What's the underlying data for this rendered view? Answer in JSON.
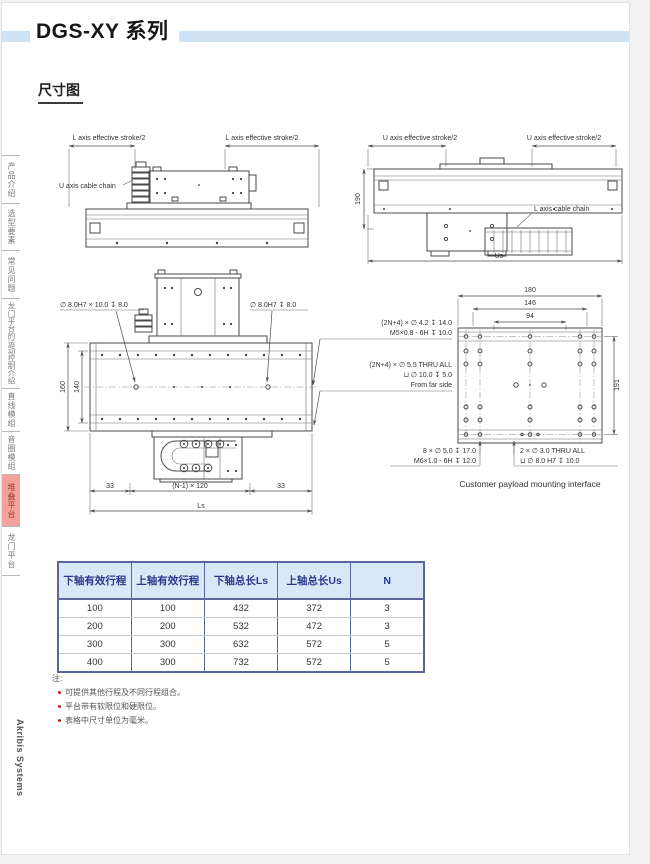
{
  "header": {
    "title": "DGS-XY 系列"
  },
  "section": {
    "title": "尺寸图"
  },
  "sidebar": {
    "items": [
      {
        "label": "产品介绍"
      },
      {
        "label": "选型要素"
      },
      {
        "label": "常见问题"
      },
      {
        "label": "龙门平台的运动控制介绍"
      },
      {
        "label": "直线模组"
      },
      {
        "label": "音圈模组"
      },
      {
        "label": "堆叠平台",
        "active": true
      },
      {
        "label": "龙门平台"
      }
    ],
    "brand": "Akribis Systems"
  },
  "drawings": {
    "top_left": {
      "stroke_label_left": "L axis effective stroke/2",
      "stroke_label_right": "L axis effective stroke/2",
      "cable_chain_label": "U axis cable chain"
    },
    "top_right": {
      "stroke_label_left": "U axis effective stroke/2",
      "stroke_label_right": "U axis effective stroke/2",
      "height_dim": "190",
      "cable_chain_label": "L axis cable chain",
      "width_dim": "Us"
    },
    "front": {
      "hole_label_left": "∅ 8.0H7 × 10.0 ↧ 8.0",
      "hole_label_right": "∅ 8.0H7 ↧ 8.0",
      "dim_160": "160",
      "dim_140": "140",
      "note_a1": "(2N+4) × ∅ 4.2 ↧ 14.0",
      "note_a2": "M5×0.8 - 6H ↧ 10.0",
      "note_b1": "(2N+4) × ∅ 5.5 THRU ALL",
      "note_b2": "⊔ ∅ 10.0 ↧ 5.0",
      "note_b3": "From far side",
      "dim_33_left": "33",
      "dim_pitch": "(N-1) × 120",
      "dim_33_right": "33",
      "dim_ls": "Ls"
    },
    "payload": {
      "dim_180": "180",
      "dim_146": "146",
      "dim_94": "94",
      "dim_191": "191",
      "note_l1": "8 × ∅ 5.0 ↧ 17.0",
      "note_l2": "M6×1.0 - 6H ↧ 12.0",
      "note_r1": "2 × ∅ 3.0 THRU ALL",
      "note_r2": "⊔ ∅ 8.0 H7 ↧ 10.0",
      "caption": "Customer payload mounting interface"
    }
  },
  "table": {
    "columns": [
      "下轴有效行程",
      "上轴有效行程",
      "下轴总长Ls",
      "上轴总长Us",
      "N"
    ],
    "rows": [
      [
        "100",
        "100",
        "432",
        "372",
        "3"
      ],
      [
        "200",
        "200",
        "532",
        "472",
        "3"
      ],
      [
        "300",
        "300",
        "632",
        "572",
        "5"
      ],
      [
        "400",
        "300",
        "732",
        "572",
        "5"
      ]
    ]
  },
  "notes": {
    "label": "注:",
    "items": [
      "可提供其他行程及不同行程组合。",
      "平台带有软限位和硬限位。",
      "表格中尺寸单位为毫米。"
    ]
  },
  "colors": {
    "accent_bar": "#cfe1f4",
    "table_header_bg": "#d9e8f7",
    "table_border": "#5b679c",
    "active_tab_bg": "#f2a29b",
    "note_bullet": "#cc2222"
  }
}
